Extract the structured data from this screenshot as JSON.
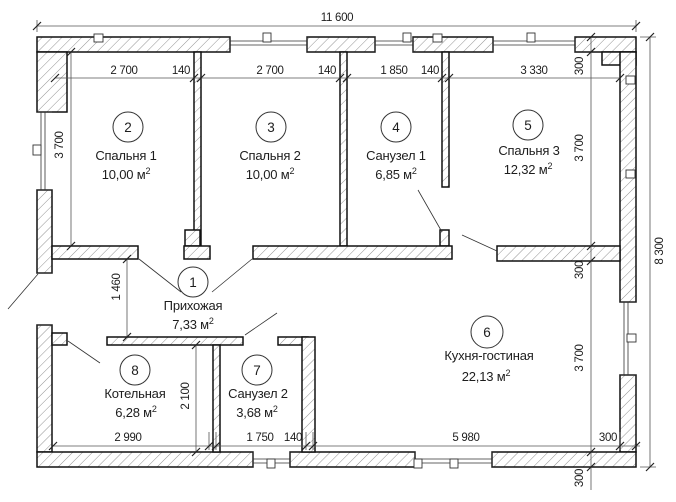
{
  "plan": {
    "rooms": [
      {
        "num": "1",
        "name": "Прихожая",
        "area": "7,33 м",
        "sup": "2"
      },
      {
        "num": "2",
        "name": "Спальня 1",
        "area": "10,00 м",
        "sup": "2"
      },
      {
        "num": "3",
        "name": "Спальня 2",
        "area": "10,00 м",
        "sup": "2"
      },
      {
        "num": "4",
        "name": "Санузел 1",
        "area": "6,85 м",
        "sup": "2"
      },
      {
        "num": "5",
        "name": "Спальня 3",
        "area": "12,32 м",
        "sup": "2"
      },
      {
        "num": "6",
        "name": "Кухня-гостиная",
        "area": "22,13 м",
        "sup": "2"
      },
      {
        "num": "7",
        "name": "Санузел 2",
        "area": "3,68 м",
        "sup": "2"
      },
      {
        "num": "8",
        "name": "Котельная",
        "area": "6,28 м",
        "sup": "2"
      }
    ],
    "dims": {
      "overall_width": "11 600",
      "overall_height": "8 300",
      "top_chain": [
        "2 700",
        "140",
        "2 700",
        "140",
        "1 850",
        "140",
        "3 330"
      ],
      "right_chain": [
        "300",
        "3 700",
        "300",
        "3 700",
        "300"
      ],
      "bedroom_depth": "3 700",
      "hallway_depth": "1 460",
      "boiler_depth": "2 100",
      "bottom_chain": [
        "2 990",
        "1 750",
        "140",
        "5 980",
        "300"
      ]
    }
  }
}
